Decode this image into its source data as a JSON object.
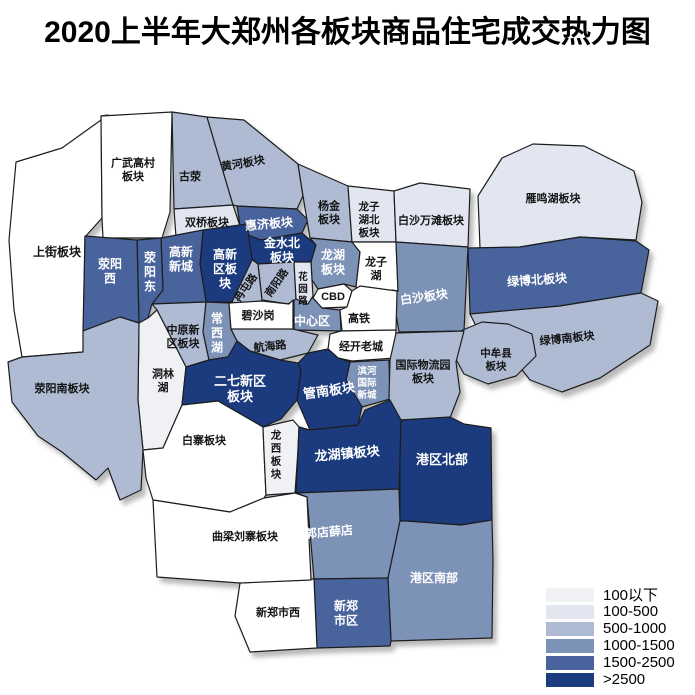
{
  "title": "2020上半年大郑州各板块商品住宅成交热力图",
  "legend": {
    "items": [
      {
        "label": "100以下",
        "color": "#f0f1f4"
      },
      {
        "label": "100-500",
        "color": "#e1e6f1"
      },
      {
        "label": "500-1000",
        "color": "#aebbd3"
      },
      {
        "label": "1000-1500",
        "color": "#7d92b7"
      },
      {
        "label": "1500-2500",
        "color": "#49639c"
      },
      {
        "label": ">2500",
        "color": "#1b3b7e"
      }
    ]
  },
  "chart_data": {
    "type": "heatmap",
    "title": "2020上半年大郑州各板块商品住宅成交热力图",
    "buckets": [
      "100以下",
      "100-500",
      "500-1000",
      "1000-1500",
      "1500-2500",
      ">2500"
    ],
    "regions": [
      {
        "name": "上街板块",
        "value_range": null
      },
      {
        "name": "广武高村板块",
        "value_range": null
      },
      {
        "name": "古荥",
        "value_range": "500-1000"
      },
      {
        "name": "黄河板块",
        "value_range": "500-1000"
      },
      {
        "name": "双桥板块",
        "value_range": "100-500"
      },
      {
        "name": "惠济板块",
        "value_range": "1500-2500"
      },
      {
        "name": "金水北板块",
        "value_range": ">2500"
      },
      {
        "name": "杨金板块",
        "value_range": "500-1000"
      },
      {
        "name": "龙子湖北板块",
        "value_range": "100-500"
      },
      {
        "name": "白沙万滩板块",
        "value_range": "100-500"
      },
      {
        "name": "雁鸣湖板块",
        "value_range": "100-500"
      },
      {
        "name": "龙湖板块",
        "value_range": "1000-1500"
      },
      {
        "name": "龙子湖",
        "value_range": null
      },
      {
        "name": "白沙板块",
        "value_range": "1000-1500"
      },
      {
        "name": "绿博北板块",
        "value_range": "1500-2500"
      },
      {
        "name": "绿博南板块",
        "value_range": "500-1000"
      },
      {
        "name": "中牟县板块",
        "value_range": "500-1000"
      },
      {
        "name": "CBD",
        "value_range": null
      },
      {
        "name": "高铁",
        "value_range": null
      },
      {
        "name": "中心区",
        "value_range": "1000-1500"
      },
      {
        "name": "经开老城",
        "value_range": null
      },
      {
        "name": "滨河国际新城",
        "value_range": "1000-1500"
      },
      {
        "name": "国际物流园板块",
        "value_range": "500-1000"
      },
      {
        "name": "南阳路",
        "value_range": "500-1000"
      },
      {
        "name": "花园路",
        "value_range": "100-500"
      },
      {
        "name": "冉屯路",
        "value_range": "500-1000"
      },
      {
        "name": "高新区板块",
        "value_range": ">2500"
      },
      {
        "name": "高新新城",
        "value_range": "1500-2500"
      },
      {
        "name": "荥阳东",
        "value_range": "1500-2500"
      },
      {
        "name": "荥阳西",
        "value_range": "1500-2500"
      },
      {
        "name": "中原新区板块",
        "value_range": "500-1000"
      },
      {
        "name": "常西湖",
        "value_range": "1000-1500"
      },
      {
        "name": "碧沙岗",
        "value_range": null
      },
      {
        "name": "航海路",
        "value_range": "500-1000"
      },
      {
        "name": "洞林湖",
        "value_range": "100以下"
      },
      {
        "name": "荥阳南板块",
        "value_range": "500-1000"
      },
      {
        "name": "二七新区板块",
        "value_range": ">2500"
      },
      {
        "name": "管南板块",
        "value_range": ">2500"
      },
      {
        "name": "白寨板块",
        "value_range": null
      },
      {
        "name": "龙西板块",
        "value_range": "100以下"
      },
      {
        "name": "龙湖镇板块",
        "value_range": ">2500"
      },
      {
        "name": "港区北部",
        "value_range": ">2500"
      },
      {
        "name": "郭店薛店",
        "value_range": "1000-1500"
      },
      {
        "name": "港区南部",
        "value_range": "1000-1500"
      },
      {
        "name": "新郑市区",
        "value_range": "1500-2500"
      },
      {
        "name": "新郑市西",
        "value_range": null
      },
      {
        "name": "曲梁刘寨板块",
        "value_range": null
      }
    ]
  },
  "map": {
    "regions": [
      {
        "name": "上街板块",
        "points": "108,115 62,148 16,162 9,240 14,310 22,357 83,352 85,237 102,218 101,116",
        "label": {
          "x": 57,
          "y": 252,
          "size": 12,
          "lines": [
            "上街板块"
          ]
        }
      },
      {
        "name": "广武高村板块",
        "points": "101,116 172,112 170,212 162,238 103,238 102,218",
        "label": {
          "x": 133,
          "y": 170,
          "size": 11,
          "lines": [
            "广武高村",
            "板块"
          ]
        }
      },
      {
        "name": "古荥",
        "points": "172,112 207,117 233,205 174,209",
        "label": {
          "x": 190,
          "y": 177,
          "size": 11,
          "lines": [
            "古荥"
          ]
        }
      },
      {
        "name": "黄河板块",
        "points": "207,117 244,120 298,164 303,196 297,209 237,206 233,205",
        "label": {
          "x": 243,
          "y": 164,
          "size": 11,
          "rotate": -10,
          "lines": [
            "黄河板块"
          ]
        }
      },
      {
        "name": "双桥板块",
        "points": "174,209 233,205 240,226 232,237 176,237",
        "label": {
          "x": 207,
          "y": 223,
          "size": 11,
          "lines": [
            "双桥板块"
          ]
        }
      },
      {
        "name": "惠济板块",
        "points": "237,206 297,209 308,220 302,233 261,240 240,232 240,226",
        "label": {
          "x": 269,
          "y": 224,
          "size": 12,
          "rotate": -5,
          "lines": [
            "惠济板块"
          ]
        }
      },
      {
        "name": "金水北板块",
        "points": "240,232 261,240 302,233 316,245 311,262 294,262 258,264 244,252",
        "label": {
          "x": 282,
          "y": 250,
          "size": 12,
          "lines": [
            "金水北",
            "板块"
          ]
        }
      },
      {
        "name": "杨金板块",
        "points": "298,164 348,186 352,242 310,238 303,196",
        "label": {
          "x": 329,
          "y": 213,
          "size": 11,
          "lines": [
            "杨金",
            "板块"
          ]
        }
      },
      {
        "name": "龙子湖北板块",
        "points": "348,186 394,191 396,242 352,242",
        "label": {
          "x": 369,
          "y": 220,
          "size": 10.5,
          "lines": [
            "龙子",
            "湖北",
            "板块"
          ]
        }
      },
      {
        "name": "白沙万滩板块",
        "points": "394,191 420,183 470,189 468,247 396,242",
        "label": {
          "x": 431,
          "y": 221,
          "size": 11,
          "lines": [
            "白沙万滩板块"
          ]
        }
      },
      {
        "name": "雁鸣湖板块",
        "points": "478,196 502,158 533,144 584,146 634,171 642,202 636,240 580,237 520,247 480,248",
        "label": {
          "x": 553,
          "y": 199,
          "size": 11,
          "lines": [
            "雁鸣湖板块"
          ]
        }
      },
      {
        "name": "龙湖板块",
        "points": "310,238 352,242 360,252 356,287 344,284 318,289 312,280 311,262 316,245",
        "label": {
          "x": 333,
          "y": 262,
          "size": 12,
          "lines": [
            "龙湖",
            "板块"
          ]
        }
      },
      {
        "name": "龙子湖",
        "points": "352,242 396,242 398,291 362,290 356,287 360,252",
        "label": {
          "x": 376,
          "y": 269,
          "size": 11,
          "lines": [
            "龙子",
            "湖"
          ]
        }
      },
      {
        "name": "白沙板块",
        "points": "396,242 468,247 464,331 399,332 392,290 398,291",
        "label": {
          "x": 424,
          "y": 297,
          "size": 12,
          "rotate": -8,
          "lines": [
            "白沙板块"
          ]
        }
      },
      {
        "name": "绿博北板块",
        "points": "468,248 520,247 580,237 636,241 649,250 641,293 560,306 470,314",
        "label": {
          "x": 537,
          "y": 280,
          "size": 12,
          "rotate": -4,
          "lines": [
            "绿博北板块"
          ]
        }
      },
      {
        "name": "绿博南板块",
        "points": "470,314 560,306 641,293 658,301 650,345 600,378 562,392 530,380 505,348 478,330",
        "label": {
          "x": 567,
          "y": 339,
          "size": 11,
          "rotate": -6,
          "lines": [
            "绿博南板块"
          ]
        }
      },
      {
        "name": "中牟县板块",
        "points": "458,332 482,322 508,324 532,334 536,356 516,376 488,384 464,374 452,352",
        "label": {
          "x": 496,
          "y": 360,
          "size": 10.5,
          "lines": [
            "中牟县",
            "板块"
          ]
        }
      },
      {
        "name": "CBD",
        "points": "318,289 344,284 352,291 347,307 322,308 313,298",
        "label": {
          "x": 333,
          "y": 297,
          "size": 11,
          "lines": [
            "CBD"
          ]
        }
      },
      {
        "name": "高铁",
        "points": "352,291 360,286 397,291 396,330 342,331 340,310 347,307",
        "label": {
          "x": 359,
          "y": 319,
          "size": 11,
          "lines": [
            "高铁"
          ]
        }
      },
      {
        "name": "中心区",
        "points": "294,299 313,298 322,308 340,310 341,331 294,330",
        "label": {
          "x": 312,
          "y": 321,
          "size": 12,
          "lines": [
            "中心区"
          ]
        }
      },
      {
        "name": "经开老城",
        "points": "330,334 341,331 396,330 395,358 352,361 338,358 328,349",
        "label": {
          "x": 361,
          "y": 347,
          "size": 11,
          "lines": [
            "经开老城"
          ]
        }
      },
      {
        "name": "滨河国际新城",
        "points": "350,362 389,360 390,399 362,407 346,380",
        "label": {
          "x": 367,
          "y": 383,
          "size": 9.5,
          "lines": [
            "滨河",
            "国际",
            "新城"
          ]
        }
      },
      {
        "name": "国际物流园板块",
        "points": "396,333 464,331 456,362 460,392 450,418 400,420 389,399 390,360",
        "label": {
          "x": 423,
          "y": 372,
          "size": 11,
          "lines": [
            "国际物流园",
            "板块"
          ]
        }
      },
      {
        "name": "南阳路",
        "points": "258,264 294,262 296,299 288,304 262,300",
        "label": {
          "x": 277,
          "y": 283,
          "size": 10.5,
          "rotate": -55,
          "lines": [
            "南阳路"
          ]
        }
      },
      {
        "name": "花园路",
        "points": "294,262 311,262 312,280 313,296 308,304 296,299",
        "label": {
          "x": 303,
          "y": 289,
          "size": 9.5,
          "lines": [
            "花",
            "园",
            "路"
          ]
        }
      },
      {
        "name": "冉屯路",
        "points": "250,258 258,264 262,300 256,307 234,304 232,302",
        "label": {
          "x": 246,
          "y": 288,
          "size": 10.5,
          "rotate": -55,
          "lines": [
            "冉屯路"
          ]
        }
      },
      {
        "name": "高新区板块",
        "points": "203,230 247,224 252,260 232,302 206,302 200,264",
        "label": {
          "x": 225,
          "y": 269,
          "size": 12,
          "lines": [
            "高新",
            "区板",
            "块"
          ]
        }
      },
      {
        "name": "高新新城",
        "points": "161,238 203,230 200,264 206,302 152,304 163,290",
        "label": {
          "x": 181,
          "y": 259,
          "size": 12,
          "lines": [
            "高新",
            "新城"
          ]
        }
      },
      {
        "name": "荥阳东",
        "points": "137,240 161,238 163,290 152,304 148,318 139,323",
        "label": {
          "x": 150,
          "y": 272,
          "size": 12,
          "lines": [
            "荥",
            "阳",
            "东"
          ]
        }
      },
      {
        "name": "荥阳西",
        "points": "85,236 137,240 139,323 120,317 83,331",
        "label": {
          "x": 110,
          "y": 271,
          "size": 12,
          "lines": [
            "荥阳",
            "西"
          ]
        }
      },
      {
        "name": "中原新区板块",
        "points": "152,304 206,302 203,332 209,360 186,367 157,310",
        "label": {
          "x": 183,
          "y": 337,
          "size": 11,
          "lines": [
            "中原新",
            "区板块"
          ]
        }
      },
      {
        "name": "常西湖",
        "points": "206,302 229,303 231,329 237,341 228,357 209,360 203,332",
        "label": {
          "x": 217,
          "y": 333,
          "size": 12,
          "lines": [
            "常",
            "西",
            "湖"
          ]
        }
      },
      {
        "name": "碧沙岗",
        "points": "229,303 262,301 289,304 293,300 293,329 262,331 231,329",
        "label": {
          "x": 258,
          "y": 316,
          "size": 11,
          "lines": [
            "碧沙岗"
          ]
        }
      },
      {
        "name": "航海路",
        "points": "231,329 293,329 318,335 308,353 280,360 250,351 237,341",
        "label": {
          "x": 270,
          "y": 347,
          "size": 11,
          "rotate": -6,
          "lines": [
            "航海路"
          ]
        }
      },
      {
        "name": "洞林湖",
        "points": "139,323 148,318 157,310 186,367 182,405 163,448 143,450 138,400",
        "label": {
          "x": 163,
          "y": 381,
          "size": 11,
          "lines": [
            "洞林",
            "湖"
          ]
        }
      },
      {
        "name": "荥阳南板块",
        "points": "22,357 83,352 83,331 120,317 139,323 138,400 143,450 141,490 120,500 108,468 96,480 62,452 38,436 12,402 8,362",
        "label": {
          "x": 62,
          "y": 389,
          "size": 11,
          "lines": [
            "荥阳南板块"
          ]
        }
      },
      {
        "name": "二七新区板块",
        "points": "186,367 209,360 228,357 237,341 250,351 280,360 298,363 301,371 297,400 281,419 263,427 218,401 182,405",
        "label": {
          "x": 240,
          "y": 388,
          "size": 13,
          "lines": [
            "二七新区",
            "板块"
          ]
        }
      },
      {
        "name": "管南板块",
        "points": "308,353 328,349 338,358 350,362 346,380 362,407 358,425 310,430 297,400 301,371 298,363",
        "label": {
          "x": 329,
          "y": 390,
          "size": 13,
          "rotate": -8,
          "lines": [
            "管南板块"
          ]
        }
      },
      {
        "name": "白寨板块",
        "points": "143,450 163,448 182,405 218,401 263,427 264,452 266,495 264,498 230,512 153,500 146,478",
        "label": {
          "x": 204,
          "y": 441,
          "size": 11,
          "lines": [
            "白寨板块"
          ]
        }
      },
      {
        "name": "龙西板块",
        "points": "263,427 293,420 299,427 298,450 295,493 266,495 264,452",
        "label": {
          "x": 276,
          "y": 455,
          "size": 10.5,
          "lines": [
            "龙",
            "西",
            "板",
            "块"
          ]
        }
      },
      {
        "name": "龙湖镇板块",
        "points": "299,427 310,430 358,425 365,410 390,400 401,420 400,460 399,489 296,493 298,450",
        "label": {
          "x": 347,
          "y": 453,
          "size": 13,
          "rotate": -5,
          "lines": [
            "龙湖镇板块"
          ]
        }
      },
      {
        "name": "港区北部",
        "points": "401,420 450,417 464,424 491,428 492,520 461,525 406,521 400,521 400,460",
        "label": {
          "x": 442,
          "y": 459,
          "size": 13,
          "lines": [
            "港区北部"
          ]
        }
      },
      {
        "name": "郭店薛店",
        "points": "296,493 399,489 400,521 396,540 388,578 314,579 307,497",
        "label": {
          "x": 329,
          "y": 532,
          "size": 12,
          "rotate": -5,
          "lines": [
            "郭店薛店"
          ]
        }
      },
      {
        "name": "港区南部",
        "points": "400,521 406,521 461,525 492,520 493,560 492,638 391,641 388,578 396,540",
        "label": {
          "x": 434,
          "y": 578,
          "size": 12,
          "lines": [
            "港区南部"
          ]
        }
      },
      {
        "name": "新郑市区",
        "points": "314,579 388,578 391,641 390,646 317,648",
        "label": {
          "x": 346,
          "y": 613,
          "size": 12,
          "lines": [
            "新郑",
            "市区"
          ]
        }
      },
      {
        "name": "新郑市西",
        "points": "240,583 314,579 317,648 250,652 235,616",
        "label": {
          "x": 278,
          "y": 613,
          "size": 11,
          "lines": [
            "新郑市西"
          ]
        }
      },
      {
        "name": "曲梁刘寨板块",
        "points": "153,500 230,512 264,498 295,493 307,497 311,580 240,583 157,577",
        "label": {
          "x": 245,
          "y": 537,
          "size": 11,
          "lines": [
            "曲梁刘寨板块"
          ]
        }
      }
    ]
  }
}
